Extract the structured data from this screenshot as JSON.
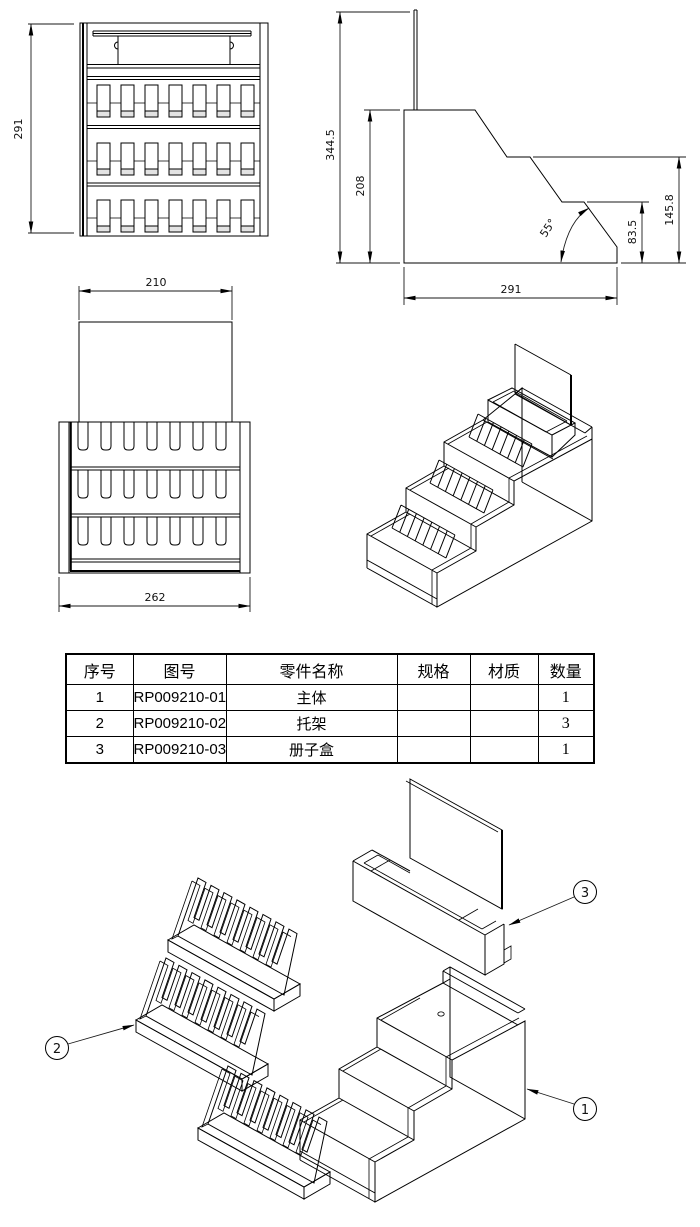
{
  "page": {
    "background": "#ffffff",
    "line_color": "#000000"
  },
  "front_view": {
    "dim_height": "291"
  },
  "side_view": {
    "dim_total_height": "344.5",
    "dim_body_height": "208",
    "dim_angle": "55°",
    "dim_lower_step": "83.5",
    "dim_upper_step": "145.8",
    "dim_depth": "291"
  },
  "top_view": {
    "dim_back_panel_width": "210",
    "dim_body_width": "262"
  },
  "bom": {
    "headers": [
      "序号",
      "图号",
      "零件名称",
      "规格",
      "材质",
      "数量"
    ],
    "rows": [
      {
        "no": "1",
        "drawing_no": "RP009210-01",
        "part_name": "主体",
        "spec": "",
        "material": "",
        "qty": "1"
      },
      {
        "no": "2",
        "drawing_no": "RP009210-02",
        "part_name": "托架",
        "spec": "",
        "material": "",
        "qty": "3"
      },
      {
        "no": "3",
        "drawing_no": "RP009210-03",
        "part_name": "册子盒",
        "spec": "",
        "material": "",
        "qty": "1"
      }
    ]
  },
  "balloons": {
    "b1": "1",
    "b2": "2",
    "b3": "3"
  }
}
